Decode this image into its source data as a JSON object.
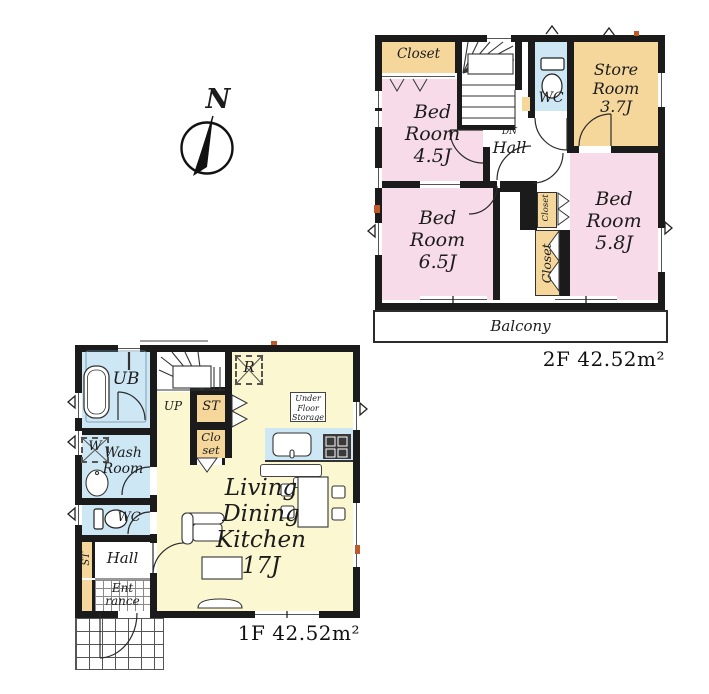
{
  "compass": {
    "north_label": "N"
  },
  "floor2": {
    "area_label": "2F 42.52m²",
    "rooms": {
      "closet_top": "Closet",
      "bedroom_45": "Bed\nRoom\n4.5J",
      "store_room": "Store\nRoom\n3.7J",
      "wc": "WC",
      "dn": "DN",
      "hall": "Hall",
      "bedroom_65": "Bed\nRoom\n6.5J",
      "bedroom_58": "Bed\nRoom\n5.8J",
      "closet_small": "Closet",
      "closet_large": "Closet",
      "balcony": "Balcony"
    }
  },
  "floor1": {
    "area_label": "1F 42.52m²",
    "rooms": {
      "ub": "UB",
      "up": "UP",
      "storage_st": "ST",
      "refrigerator": "R",
      "under_floor_storage": "Under\nFloor\nStorage",
      "washer": "W",
      "wash_room": "Wash\nRoom",
      "closet": "Clo\nset",
      "wc": "WC",
      "st_side": "ST",
      "hall": "Hall",
      "entrance": "Ent\nrance",
      "ldk": "Living\nDining\nKitchen\n17J"
    }
  },
  "colors": {
    "wall": "#1b1b1b",
    "bedroom_pink": "#f8dbe9",
    "closet_tan": "#f5d79c",
    "wet_blue": "#cde7f5",
    "ldk_yellow": "#fbf7d0",
    "accent_orange": "#c05a28",
    "line": "#222222"
  }
}
